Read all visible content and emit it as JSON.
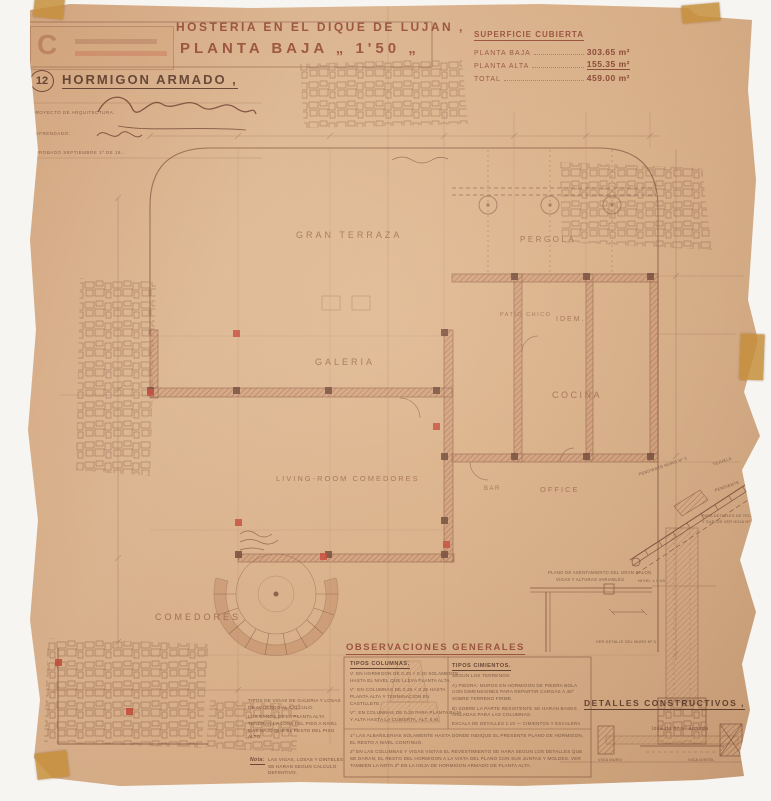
{
  "colors": {
    "paper": "#d9ad83",
    "ink": "#6f3c28",
    "accent_red": "#c23524",
    "title_red": "#8e3a26"
  },
  "sheet": {
    "number": "12",
    "stamp_letter": "C",
    "title_line1": "HOSTERIA EN EL DIQUE DE LUJAN ,",
    "title_line2": "PLANTA BAJA „ 1'50 „",
    "material_heading": "HORMIGON ARMADO ,"
  },
  "signature_block": {
    "row1_label": "PROYECTO DE ARQUITECTURA:",
    "row2_label": "REFRENDADO:",
    "row3_label": "APROBADO SEPTIEMBRE 1º DE 19.."
  },
  "area_table": {
    "heading": "SUPERFICIE CUBIERTA",
    "rows": [
      {
        "label": "PLANTA BAJA",
        "value": "303.65 m²"
      },
      {
        "label": "PLANTA ALTA",
        "value": "155.35 m²"
      },
      {
        "label": "TOTAL",
        "value": "459.00 m²"
      }
    ]
  },
  "rooms": {
    "gran_terraza": "GRAN TERRAZA",
    "pergola": "PERGOLA",
    "patio_chico": "PATIO CHICO",
    "idem": "IDEM.",
    "galeria": "GALERIA",
    "cocina": "COCINA",
    "living": "LIVING-ROOM COMEDORES",
    "bar": "BAR",
    "office": "OFFICE",
    "comedores": "COMEDORES"
  },
  "observations": {
    "heading": "OBSERVACIONES GENERALES",
    "columns_heading": "TIPOS COLUMNAS.",
    "columns_lines": [
      "V: EN HORMIGON DE 0.20 × 0.20 SOLAMENTE HASTA EL NIVEL QUE LLEVA PLANTA ALTA.",
      "V': EN COLUMNAS DE 0.25 × 0.25 HASTA PLANTA ALTA Y TERMINACION EN CASTILLETE.",
      "V'': EN COLUMNAS DE 0.30 PARA PLANTA BAJA Y ALTA HASTA LA CUBIERTA, ALT. 5 M."
    ],
    "cimientos_heading": "TIPOS CIMIENTOS.",
    "cimientos_lines": [
      "SEGUN LOS TERRENOS:",
      "A) PIEDRA: MUROS EN HORMIGON DE PIEDRA BOLA CON DIMENSIONES PARA REPARTIR CARGAS A 45º SOBRE TERRENO FIRME.",
      "B) SOBRE LA PARTE RESISTENTE SE HARAN BASES AISLADAS PARA LAS COLUMNAS."
    ],
    "scale_note": "ESCALA DE DETALLES 1:10 — CIMIENTOS Y ESCALERA",
    "numbered_notes": [
      "1º LAS ALBAÑILERIAS SOLAMENTE HASTA DONDE INDIQUE EL PRESENTE PLANO DE HORMIGON, EL RESTO A NIVEL CONTINUO.",
      "2º EN LAS COLUMNAS Y VIGAS VISTAS EL REVESTIMIENTO SE HARA SEGUN LOS DETALLES QUE SE DARAN; EL RESTO DEL HORMIGON A LA VISTA DEL PLANO CON SUS JUNTAS Y MOLDES. VER TAMBIEN LA NOTA 2ª EN LA HOJA DE HORMIGON ARMADO DE PLANTA ALTA."
    ]
  },
  "left_notes": {
    "line1": "TIPOS DE VIGAS DE GALERIA Y LOSAS DE ACUERDO AL CALCULO.",
    "line2": "LOS BAÑOS DE LA PLANTA ALTA TENDRAN LA LOSA DEL PISO A NIVEL MAS BAJO QUE EL RESTO DEL PISO ALTO.",
    "nota_label": "Nota:",
    "nota_text": "LAS VIGAS, LOSAS Y DINTELES SE HARAN SEGUN CALCULO DEFINITIVO."
  },
  "details": {
    "heading": "DETALLES CONSTRUCTIVOS ,",
    "roof": {
      "label_pendiente_muro": "PENDIENTE MURO Nº 3",
      "label_tejuela": "TEJUELA",
      "label_pendiente": "PENDIENTE",
      "note": "PARA DETALLES DE TECHOS Y SUELOS VER HOJA Nº 13",
      "nivel": "NIVEL ± 0.00"
    },
    "asentamiento": {
      "caption_line1": "PLANO DE ASENTAMIENTO DEL GRAN SALON",
      "caption_line2": "VIGAS Y ALTURAS VARIABLES",
      "small_note": "VER DETALLE DEL MURO Nº 3"
    },
    "beam": {
      "caption": "losa de hº aº armada",
      "left_label": "VIGA MURO",
      "right_label": "VIGA DINTEL"
    }
  }
}
